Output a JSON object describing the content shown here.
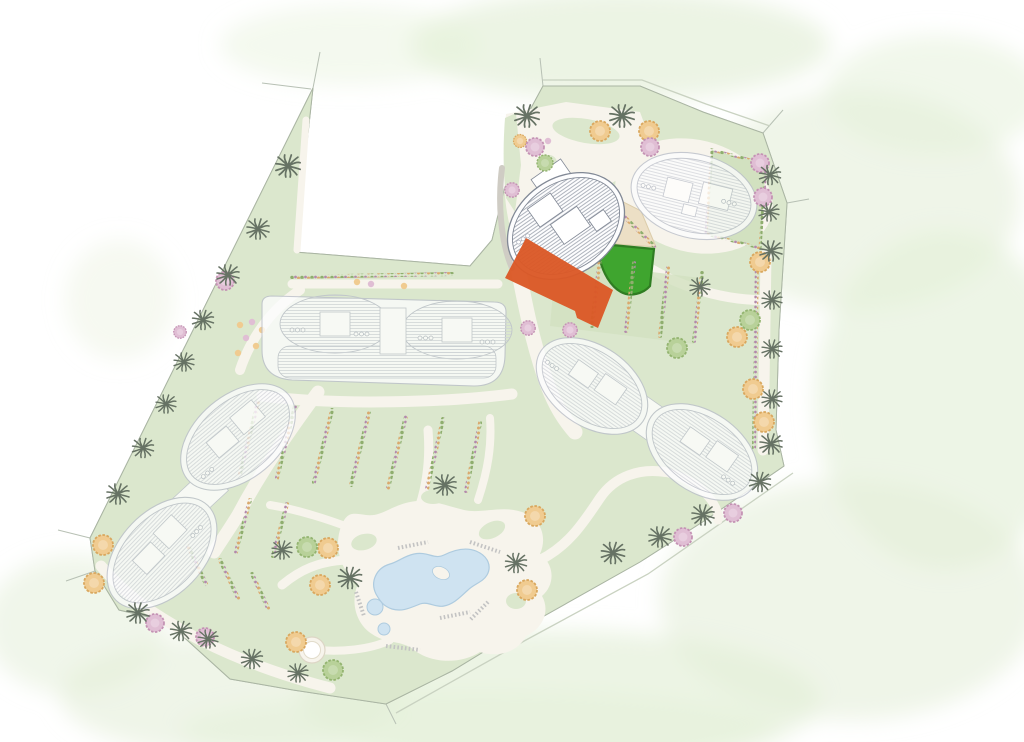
{
  "map": {
    "type": "residential-compound-site-master-plan",
    "colors": {
      "background": "#ffffff",
      "watercolor": "#e4efd8",
      "site_green": "#dbe7cd",
      "garden_green": "#d2e1c0",
      "path_cream": "#f7f4ec",
      "pool_blue": "#cfe3f1",
      "pool_stroke": "#aecbdf",
      "building_fill": "#fdfdfe",
      "building_line": "#b9bec9",
      "building_line_active": "#818895",
      "hatch": "#ccd0d8",
      "hatch_active": "#9aa1ac",
      "highlight_orange": "#db5826",
      "lawn_green": "#3fa52f",
      "lawn_border": "#2f7d22",
      "sand": "#ecdfc5",
      "palm": "#667264",
      "tree_tan": "#f0cb90",
      "tree_pink": "#e0bed4",
      "tree_green": "#b8d199",
      "hedge_green": "#8fae6e",
      "hedge_purple": "#b389ab",
      "hedge_tan": "#d9a96e",
      "boundary_line": "#aab5a3"
    },
    "selection": {
      "highlight_color": "#db5826",
      "lawn_color": "#3fa52f"
    },
    "features": {
      "building_footprints": 7,
      "selected_building_highlight": true,
      "selected_garden_lawn": true,
      "swimming_pool": true,
      "pool_deck": true,
      "garden_plots": true,
      "perimeter_palm_trees": true
    },
    "trees": {
      "palms": [
        [
          288,
          166,
          1.1
        ],
        [
          258,
          229
        ],
        [
          228,
          275
        ],
        [
          203,
          320,
          0.95
        ],
        [
          184,
          362,
          0.9
        ],
        [
          166,
          404,
          0.9
        ],
        [
          143,
          448,
          0.95
        ],
        [
          118,
          494
        ],
        [
          138,
          613
        ],
        [
          181,
          631,
          0.95
        ],
        [
          208,
          639,
          0.9
        ],
        [
          252,
          659,
          0.95
        ],
        [
          298,
          673,
          0.9
        ],
        [
          613,
          553,
          1.05
        ],
        [
          660,
          537
        ],
        [
          703,
          515
        ],
        [
          770,
          175,
          0.95
        ],
        [
          769,
          212,
          0.9
        ],
        [
          771,
          251
        ],
        [
          772,
          300,
          0.9
        ],
        [
          772,
          349,
          0.9
        ],
        [
          772,
          399,
          0.9
        ],
        [
          771,
          444
        ],
        [
          760,
          482,
          0.95
        ],
        [
          527,
          116,
          1.1
        ],
        [
          622,
          116,
          1.1
        ],
        [
          445,
          485
        ],
        [
          350,
          578,
          1.05
        ],
        [
          516,
          563,
          0.95
        ],
        [
          282,
          550,
          0.9
        ],
        [
          700,
          287,
          0.9
        ]
      ],
      "round": [
        [
          103,
          545,
          "tan"
        ],
        [
          94,
          583,
          "tan"
        ],
        [
          320,
          585,
          "tan"
        ],
        [
          296,
          642,
          "tan"
        ],
        [
          535,
          516,
          "tan"
        ],
        [
          527,
          590,
          "tan"
        ],
        [
          600,
          131,
          "tan"
        ],
        [
          649,
          131,
          "tan"
        ],
        [
          737,
          337,
          "tan"
        ],
        [
          753,
          389,
          "tan"
        ],
        [
          764,
          422,
          "tan"
        ],
        [
          328,
          548,
          "tan"
        ],
        [
          760,
          262,
          "tan"
        ],
        [
          520,
          141,
          "tan",
          0.65
        ],
        [
          225,
          281,
          "pink"
        ],
        [
          760,
          163,
          "pink"
        ],
        [
          763,
          197,
          "pink"
        ],
        [
          155,
          623,
          "pink"
        ],
        [
          205,
          637,
          "pink"
        ],
        [
          683,
          537,
          "pink"
        ],
        [
          733,
          513,
          "pink"
        ],
        [
          535,
          147,
          "pink"
        ],
        [
          650,
          147,
          "pink"
        ],
        [
          512,
          190,
          "pink",
          0.8
        ],
        [
          528,
          328,
          "pink",
          0.8
        ],
        [
          570,
          330,
          "pink",
          0.8
        ],
        [
          180,
          332,
          "pink",
          0.7
        ],
        [
          750,
          320,
          "green"
        ],
        [
          333,
          670,
          "green"
        ],
        [
          307,
          547,
          "green"
        ],
        [
          677,
          348,
          "green"
        ],
        [
          545,
          163,
          "green",
          0.8
        ]
      ],
      "shrubs": [
        [
          240,
          325,
          "t"
        ],
        [
          252,
          322,
          "p"
        ],
        [
          262,
          330,
          "t"
        ],
        [
          246,
          338,
          "p"
        ],
        [
          256,
          346,
          "t"
        ],
        [
          238,
          353,
          "t"
        ],
        [
          357,
          282,
          "t"
        ],
        [
          371,
          284,
          "p"
        ],
        [
          404,
          286,
          "t"
        ],
        [
          548,
          141,
          "p"
        ]
      ]
    },
    "hedgerows": [
      [
        258,
        402,
        240,
        474
      ],
      [
        295,
        406,
        277,
        478
      ],
      [
        332,
        410,
        314,
        482
      ],
      [
        369,
        413,
        351,
        485
      ],
      [
        406,
        416,
        388,
        488
      ],
      [
        443,
        419,
        427,
        489
      ],
      [
        480,
        423,
        466,
        491
      ],
      [
        250,
        500,
        236,
        552
      ],
      [
        287,
        504,
        273,
        556
      ],
      [
        188,
        546,
        206,
        584
      ],
      [
        220,
        560,
        238,
        598
      ],
      [
        252,
        574,
        268,
        608
      ],
      [
        600,
        258,
        592,
        326
      ],
      [
        634,
        263,
        626,
        331
      ],
      [
        668,
        268,
        660,
        336
      ],
      [
        702,
        273,
        694,
        341
      ],
      [
        757,
        258,
        754,
        448
      ],
      [
        292,
        277,
        452,
        274
      ],
      [
        585,
        178,
        654,
        246
      ]
    ]
  }
}
